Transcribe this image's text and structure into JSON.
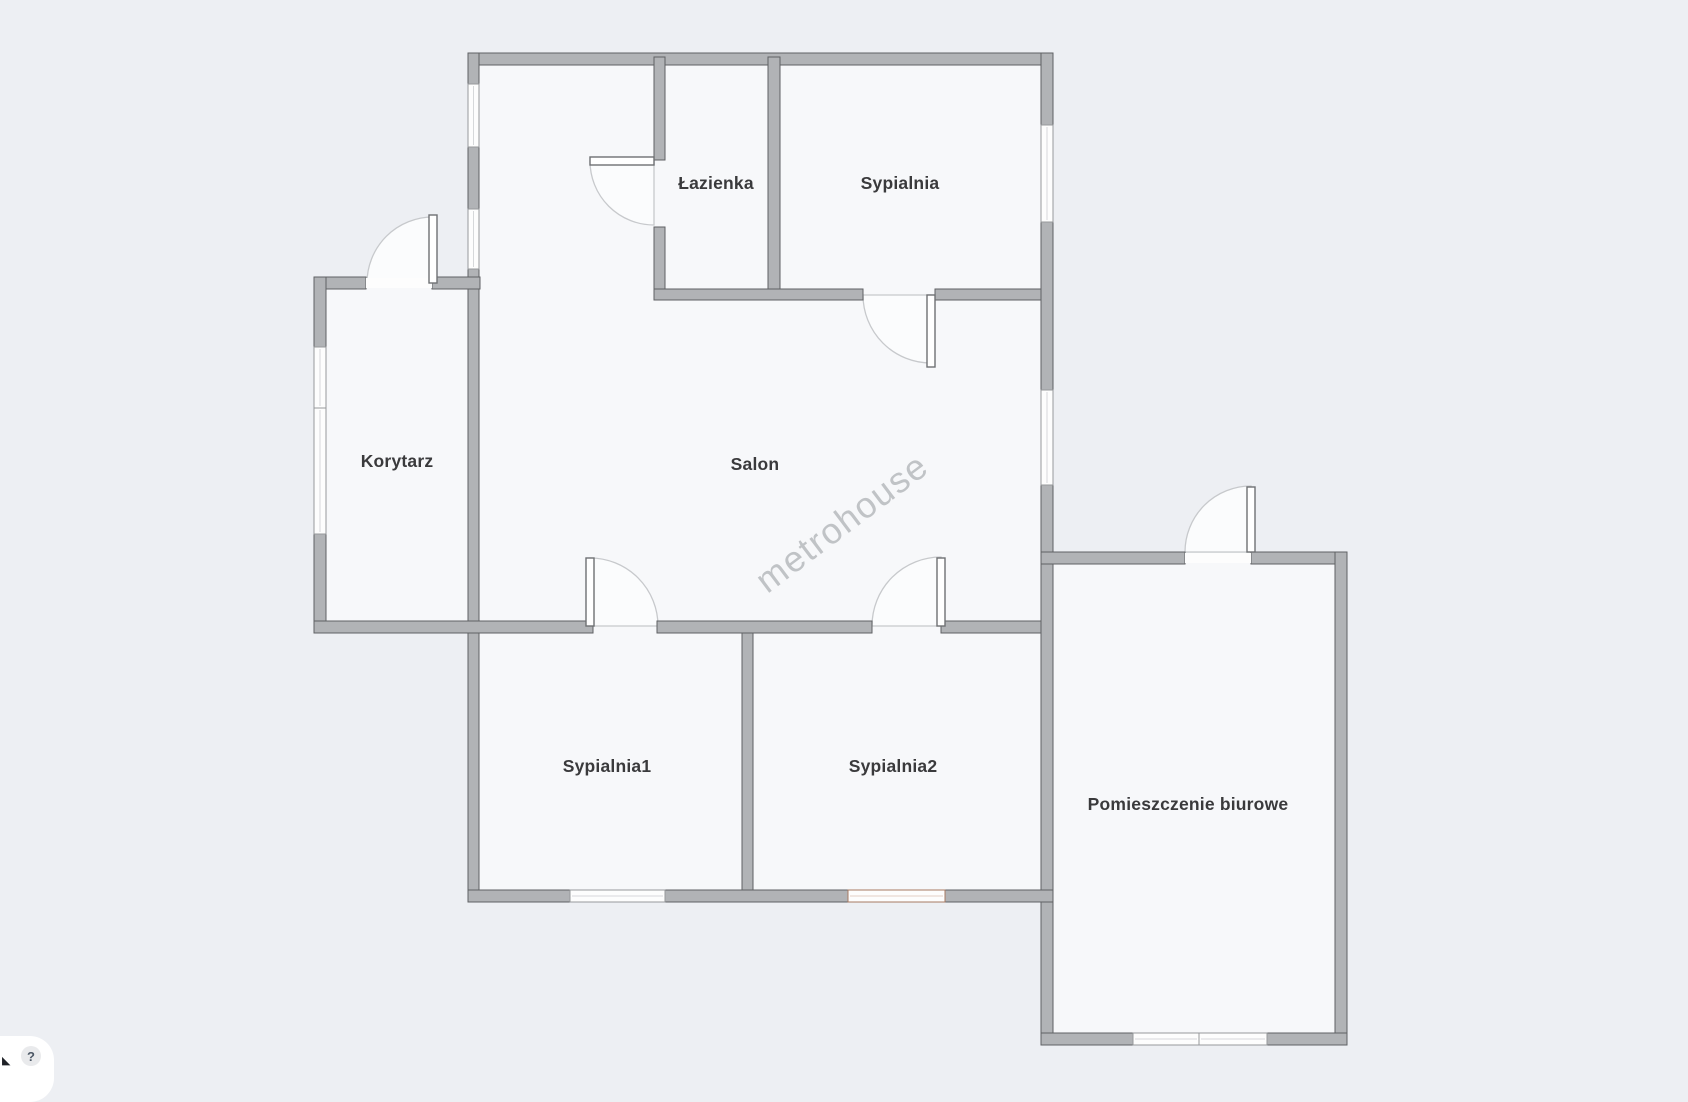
{
  "colors": {
    "background": "#edeff3",
    "room_fill": "#f7f8fa",
    "wall_fill": "#b1b3b6",
    "wall_outline": "#5f6164",
    "window_fill": "#fdfdfd",
    "window_frame": "#97999c",
    "accent_window_frame": "#a87a62",
    "door_leaf_fill": "#ffffff",
    "door_leaf_stroke": "#6e7073",
    "door_swing_stroke": "#c7c9cc",
    "door_swing_fill": "#fbfcfd",
    "label_color": "#3a3a3c",
    "watermark_color": "#94979b",
    "widget_bg": "#ffffff",
    "help_circle_bg": "#e9eaec",
    "help_icon_color": "#4d5866",
    "resize_icon_color": "#1f2227"
  },
  "floor_plan": {
    "watermark": "metrohouse",
    "rooms": [
      {
        "label": "Łazienka"
      },
      {
        "label": "Sypialnia"
      },
      {
        "label": "Korytarz"
      },
      {
        "label": "Salon"
      },
      {
        "label": "Sypialnia1"
      },
      {
        "label": "Sypialnia2"
      },
      {
        "label": "Pomieszczenie biurowe"
      }
    ]
  },
  "corner_widget": {
    "resize_icon": "◣",
    "help_icon": "?"
  }
}
